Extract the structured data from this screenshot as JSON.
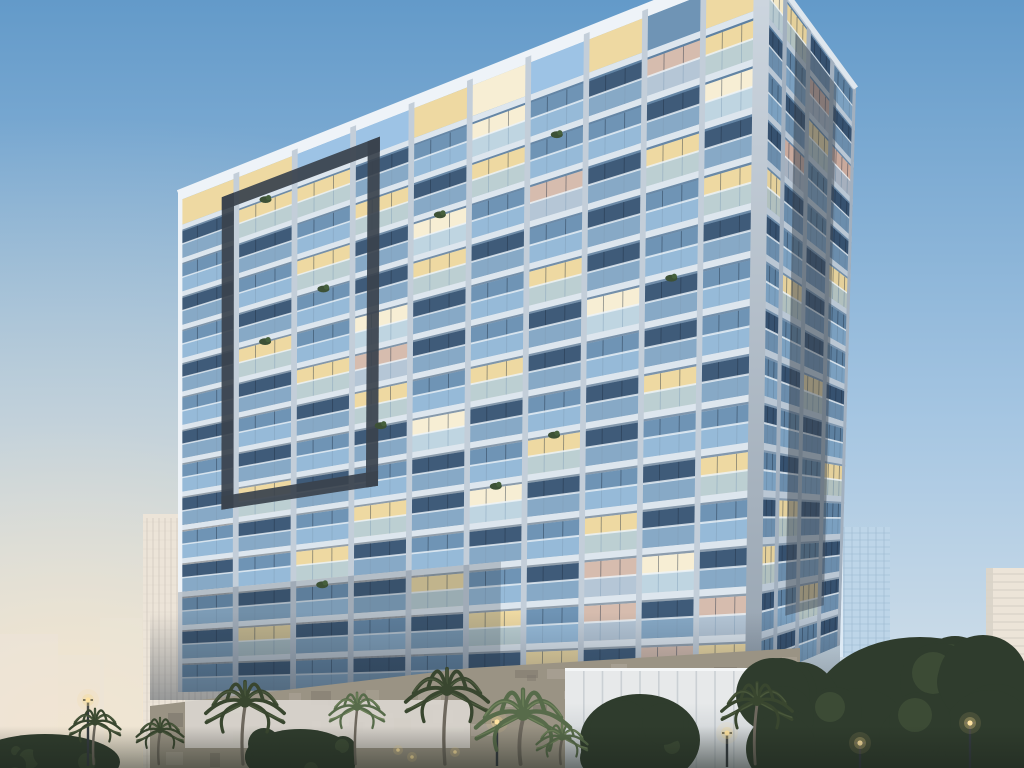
{
  "scene": {
    "description": "Dusk architectural rendering of a modern high-rise residential tower with glass balconies and warm lit windows, flanked by background towers, palm trees, street lamps and a stone podium wall",
    "time_of_day": "dusk"
  },
  "colors": {
    "sky_top": "#639ac9",
    "sky_mid": "#a6c6e2",
    "sky_low": "#dde6eb",
    "sky_horizon": "#f7e6cb",
    "sky_open": "#9dc3e5",
    "slab": "#dde6ee",
    "slab_shadow": "#55657a",
    "pier": "#c3ced9",
    "parapet": "#eef3f8",
    "glass_dark": "#3f5b79",
    "glass_light": "#6f94b5",
    "window_lit": "#eed9a2",
    "window_bright": "#f7eed4",
    "window_pink": "#d6bcae",
    "balcony": "#a6cbe7",
    "glass_dark_r": "#36516f",
    "glass_light_r": "#5d80a0",
    "window_lit_r": "#e4d09b",
    "window_bright_r": "#f2e7c5",
    "window_pink_r": "#c9a99c",
    "balcony_r": "#90b5d5",
    "slab_r": "#bac7d4",
    "pier_r": "#a2b0bf",
    "dark_frame": "#3a434e",
    "corner_top": "#cfd8e1",
    "corner_bottom": "#97a4b1",
    "mullion": "#1e2d40",
    "bg_warm": "#ece4d8",
    "bg_warm_light": "#f6efe3",
    "bg_lines": "#d0c9bf",
    "bg_glass": "#bdd5e8",
    "bg_glass_lines": "#9cb8d0",
    "stone": "#9a9384",
    "stone_dark": "#7c756a",
    "stone_light": "#b2aa9e",
    "panel": "#e7e9ea",
    "panel_seam": "#cbd0d4",
    "pale_wall": "#dcd7d0",
    "tree_dark": "#2f3c2d",
    "tree_mid": "#47573d",
    "palm_dark": "#39462f",
    "palm_dark2": "#4a583c",
    "palm_green": "#576b4a",
    "palm_green2": "#6d8059",
    "palm_trunk": "#6e685e",
    "lamp_core": "#ffe3a1",
    "lamp_glow": "#f6d88c",
    "shadow": "#223040",
    "bottom_shade": "#1d241d"
  },
  "main_tower": {
    "left_facade": {
      "tl": [
        178,
        193
      ],
      "tr": [
        762,
        -40
      ],
      "bl": [
        178,
        692
      ],
      "br": [
        753,
        682
      ],
      "floors": 15,
      "bays": 10,
      "pergola_row": "LLOOLBOLGL",
      "rows": [
        "gLLgGBGgPL",
        "GgGLgLGGgB",
        "gGLgBGPgLg",
        "GgGgLgGgGL",
        "gLGBgGLgGg",
        "GgLPgGgBgG",
        "gGgLGLgGgG",
        "GgGgBgGgLg",
        "gLgGgGLgGG",
        "GgGLgBgGgL",
        "gGLgGgGLgG",
        "GgGgLGgPBg",
        "gLgGgLGPgP",
        "GgGgGgLgPL"
      ]
    },
    "right_facade": {
      "tl": [
        762,
        -40
      ],
      "tr": [
        856,
        88
      ],
      "bl": [
        753,
        682
      ],
      "br": [
        840,
        645
      ],
      "floors": 15,
      "bays": 4,
      "rows": [
        "BLgG",
        "gGPg",
        "GgLP",
        "gPGg",
        "LgGg",
        "gGgL",
        "GLgG",
        "gGgG",
        "GgLg",
        "gGgG",
        "GgGL",
        "gLgG",
        "LgGg",
        "gGLg",
        "GgGg"
      ]
    },
    "dark_frame": {
      "u1": 0.075,
      "u2": 0.346,
      "v1": 0.042,
      "v2": 0.648,
      "tu": 0.021,
      "tv": 0.026
    },
    "right_dark_strip": {
      "u1": 0.36,
      "u2": 0.8,
      "v1": 0.04,
      "v2": 0.92,
      "opacity": 0.48
    },
    "corner": [
      [
        754,
        -40
      ],
      [
        770,
        -39
      ],
      [
        761,
        683
      ],
      [
        745,
        683
      ]
    ],
    "balcony_plants": [
      [
        1,
        1
      ],
      [
        2,
        6
      ],
      [
        3,
        4
      ],
      [
        4,
        2
      ],
      [
        5,
        1
      ],
      [
        6,
        8
      ],
      [
        8,
        3
      ],
      [
        9,
        6
      ],
      [
        10,
        5
      ],
      [
        12,
        2
      ]
    ]
  },
  "background": {
    "left_towers": [
      {
        "x": 143,
        "y": 514,
        "w": 92,
        "h": 254
      },
      {
        "x": 287,
        "y": 584,
        "w": 66,
        "h": 184
      },
      {
        "x": 350,
        "y": 556,
        "w": 74,
        "h": 212
      }
    ],
    "faint_blocks": [
      {
        "x": 0,
        "y": 634,
        "w": 58,
        "h": 134,
        "opacity": 0.55
      },
      {
        "x": 58,
        "y": 655,
        "w": 46,
        "h": 113,
        "opacity": 0.5
      },
      {
        "x": 100,
        "y": 618,
        "w": 42,
        "h": 150,
        "opacity": 0.45
      },
      {
        "x": 240,
        "y": 690,
        "w": 50,
        "h": 78,
        "opacity": 0.35
      }
    ],
    "glass_tower": {
      "x": 840,
      "y": 527,
      "w": 50,
      "h": 130
    },
    "white_tower": {
      "x": 986,
      "y": 568,
      "w": 38,
      "h": 132
    },
    "low_building": {
      "x": 945,
      "y": 638,
      "w": 48,
      "h": 45
    }
  },
  "podium": {
    "stone_wall": [
      [
        150,
        706
      ],
      [
        470,
        668
      ],
      [
        800,
        648
      ],
      [
        800,
        768
      ],
      [
        150,
        768
      ]
    ],
    "pale_wall": {
      "x": 185,
      "y": 700,
      "w": 285,
      "h": 48
    },
    "panel_wall": {
      "x": 565,
      "y": 668,
      "w": 225,
      "h": 100,
      "seams": 11
    },
    "wall_lights": [
      [
        333,
        754
      ],
      [
        398,
        750
      ],
      [
        412,
        757
      ],
      [
        455,
        752
      ],
      [
        612,
        744
      ],
      [
        675,
        741
      ]
    ]
  },
  "vegetation": {
    "tree_masses": [
      {
        "cx": 920,
        "cy": 715,
        "rx": 110,
        "ry": 78
      },
      {
        "cx": 800,
        "cy": 720,
        "rx": 45,
        "ry": 58
      },
      {
        "cx": 640,
        "cy": 740,
        "rx": 60,
        "ry": 46
      },
      {
        "cx": 300,
        "cy": 757,
        "rx": 55,
        "ry": 28
      },
      {
        "cx": 45,
        "cy": 762,
        "rx": 75,
        "ry": 28
      }
    ],
    "palms": [
      {
        "x": 95,
        "y": 722,
        "r": 26,
        "tone": "dark"
      },
      {
        "x": 160,
        "y": 730,
        "r": 24,
        "tone": "dark"
      },
      {
        "x": 245,
        "y": 702,
        "r": 40,
        "tone": "dark"
      },
      {
        "x": 357,
        "y": 707,
        "r": 28,
        "tone": "green"
      },
      {
        "x": 447,
        "y": 690,
        "r": 42,
        "tone": "dark"
      },
      {
        "x": 523,
        "y": 714,
        "r": 48,
        "tone": "green"
      },
      {
        "x": 562,
        "y": 737,
        "r": 26,
        "tone": "green"
      },
      {
        "x": 757,
        "y": 701,
        "r": 36,
        "tone": "dark"
      }
    ],
    "lamps": [
      {
        "x": 88,
        "y": 700,
        "h": 66
      },
      {
        "x": 497,
        "y": 722,
        "h": 44
      },
      {
        "x": 727,
        "y": 733,
        "h": 34
      },
      {
        "x": 860,
        "y": 743,
        "h": 25
      },
      {
        "x": 970,
        "y": 723,
        "h": 45
      }
    ]
  }
}
